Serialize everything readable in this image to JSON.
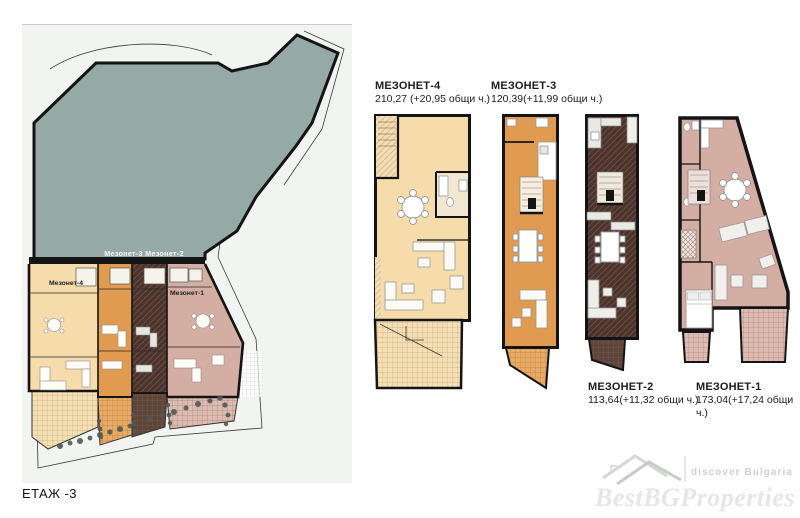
{
  "page": {
    "floor_label": "ЕТАЖ -3"
  },
  "site_plan": {
    "band_label": "Мезонет-3  Мезонет-2",
    "unit4_label": "Мезонет-4",
    "unit1_label": "Мезонет-1"
  },
  "plans": [
    {
      "id": "mezonet-4",
      "title": "МЕЗОНЕТ-4",
      "area": "210,27 (+20,95 общи ч.)"
    },
    {
      "id": "mezonet-3",
      "title": "МЕЗОНЕТ-3",
      "area": "120,39(+11,99 общи ч.)"
    },
    {
      "id": "mezonet-2",
      "title": "МЕЗОНЕТ-2",
      "area": "113,64(+11,32 общи ч.)"
    },
    {
      "id": "mezonet-1",
      "title": "МЕЗОНЕТ-1",
      "area": "173,04(+17,24 общи ч.)"
    }
  ],
  "watermark": {
    "tagline": "discover Bulgaria",
    "brand": "BestBGProperties"
  },
  "colors": {
    "sage": "#95a9a6",
    "cream": "#f6dcaa",
    "cream_terrace": "#f4e0b8",
    "orange": "#e19b50",
    "brown": "#4b342c",
    "mauve": "#d4ada3",
    "wall": "#141414",
    "vegetation": "#4e5a52",
    "panel_bg": "#f1f4f1",
    "watermark_gray": "#dfe3df"
  }
}
